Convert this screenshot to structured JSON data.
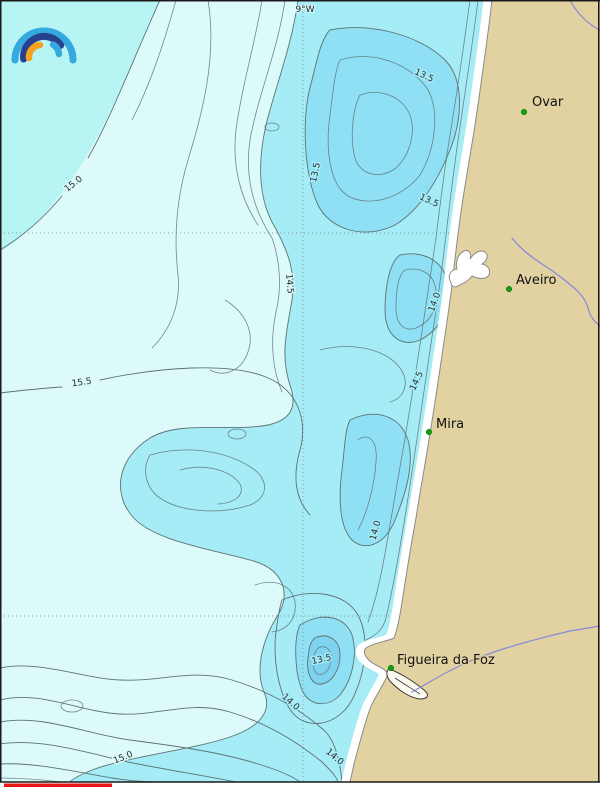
{
  "map": {
    "title_hint": "coastal sea temperature contour map",
    "graticule": {
      "lon_label": "9°W"
    },
    "places": [
      {
        "name": "Ovar"
      },
      {
        "name": "Aveiro"
      },
      {
        "name": "Mira"
      },
      {
        "name": "Figueira da Foz"
      }
    ],
    "contour_labels": [
      {
        "value": "15.0"
      },
      {
        "value": "13.5"
      },
      {
        "value": "13.5"
      },
      {
        "value": "13.5"
      },
      {
        "value": "14.5"
      },
      {
        "value": "14.0"
      },
      {
        "value": "14.5"
      },
      {
        "value": "15.5"
      },
      {
        "value": "14.0"
      },
      {
        "value": "13.5"
      },
      {
        "value": "14.0"
      },
      {
        "value": "15.0"
      },
      {
        "value": "14.0"
      }
    ],
    "colors": {
      "sea_pale": "#dcfafa",
      "sea_light": "#b7f4f4",
      "sea_mid": "#a5ecf7",
      "sea_deep": "#8fe0f5",
      "sea_deepest": "#7ed4f0",
      "land": "#e2d2a2",
      "beach": "#ffffff",
      "river": "#8688da",
      "city_dot": "#12a012",
      "colorbar_fragment": "#e81515",
      "logo_blue": "#35a8de",
      "logo_dark_blue": "#27418f",
      "logo_orange": "#f6a21c"
    }
  }
}
